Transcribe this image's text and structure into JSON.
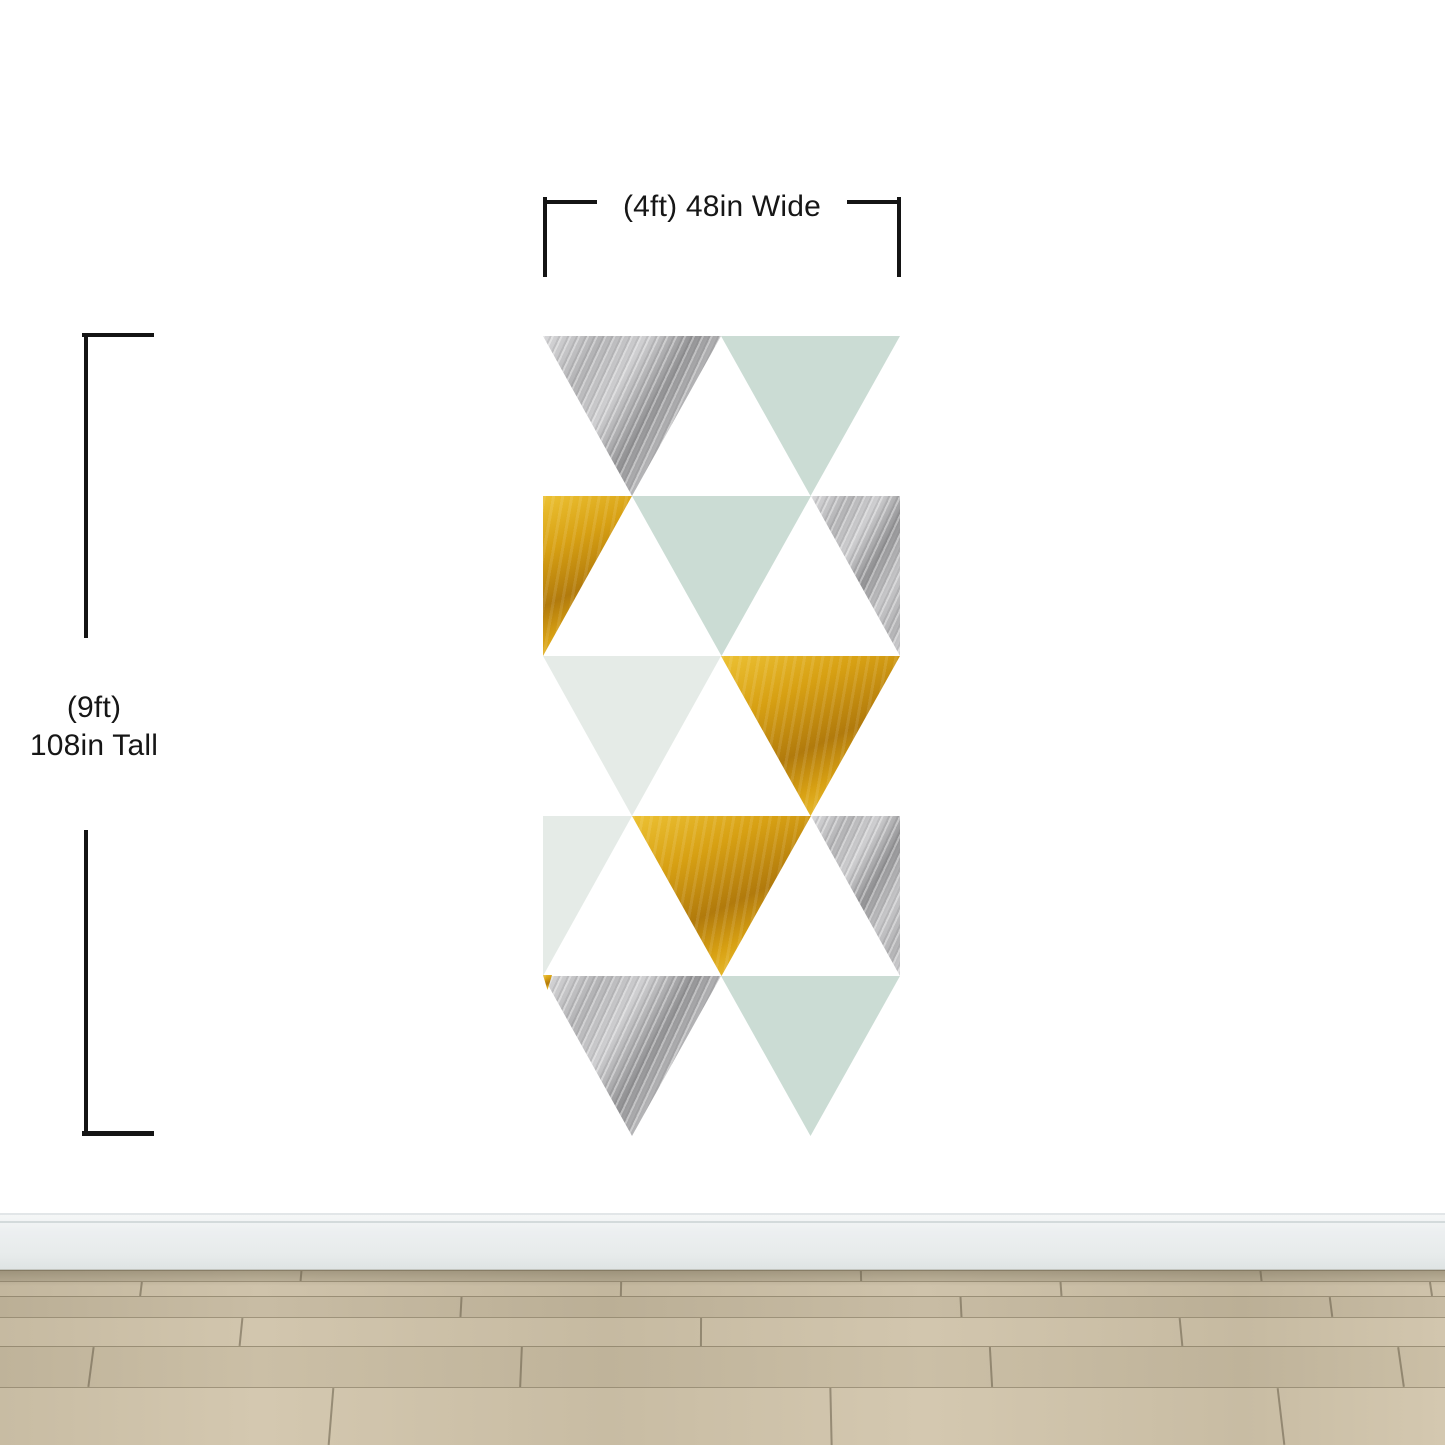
{
  "annotations": {
    "width_label": "(4ft) 48in Wide",
    "height_label_line1": "(9ft)",
    "height_label_line2": "108in Tall"
  },
  "colors": {
    "wall": "#ffffff",
    "ink": "#161616",
    "mint": "#cbdcd4",
    "mint_pale": "#e5ebe7",
    "silver_base": "#b3b3b5",
    "silver_light": "#d8d8da",
    "silver_dark": "#939395",
    "gold_base": "#d7a013",
    "gold_light": "#ecc133",
    "gold_dark": "#b17a0c",
    "baseboard": "#e7ebeb",
    "floor_base": "#c2b69c"
  },
  "mural": {
    "left": 543,
    "top": 336,
    "width": 357,
    "height": 800,
    "row_height": 160,
    "rows": [
      {
        "cells": [
          {
            "l": 0,
            "w": 178,
            "shape": "down",
            "color": "silver"
          },
          {
            "l": 178,
            "w": 179,
            "shape": "down",
            "color": "mint"
          }
        ]
      },
      {
        "cells": [
          {
            "l": 0,
            "w": 89,
            "shape": "halfL",
            "color": "gold"
          },
          {
            "l": 89,
            "w": 179,
            "shape": "down",
            "color": "mint"
          },
          {
            "l": 268,
            "w": 89,
            "shape": "halfR",
            "color": "silver"
          }
        ]
      },
      {
        "cells": [
          {
            "l": 0,
            "w": 178,
            "shape": "down",
            "color": "mint_pale"
          },
          {
            "l": 178,
            "w": 179,
            "shape": "down",
            "color": "gold"
          }
        ]
      },
      {
        "cells": [
          {
            "l": 0,
            "w": 89,
            "shape": "halfL",
            "color": "mint_pale"
          },
          {
            "l": 89,
            "w": 179,
            "shape": "down",
            "color": "gold"
          },
          {
            "l": 268,
            "w": 89,
            "shape": "halfR",
            "color": "silver"
          }
        ]
      },
      {
        "cells": [
          {
            "l": 0,
            "w": 178,
            "shape": "down",
            "color": "silver"
          },
          {
            "l": 178,
            "w": 179,
            "shape": "down",
            "color": "mint"
          }
        ]
      }
    ],
    "slivers": [
      {
        "l": 0,
        "t": 639,
        "w": 9,
        "h": 15,
        "shape": "down",
        "color": "gold"
      }
    ]
  },
  "floor": {
    "rows": [
      {
        "h": 11,
        "c1": "#b8ad95",
        "c2": "#c4b9a1",
        "joints": [
          300,
          860,
          1260
        ]
      },
      {
        "h": 15,
        "c1": "#c3b79e",
        "c2": "#cfc3ab",
        "joints": [
          140,
          620,
          1060,
          1430
        ]
      },
      {
        "h": 21,
        "c1": "#bbaf96",
        "c2": "#c8bca4",
        "joints": [
          460,
          960,
          1330
        ]
      },
      {
        "h": 29,
        "c1": "#c6baa1",
        "c2": "#d2c6ae",
        "joints": [
          240,
          700,
          1180
        ]
      },
      {
        "h": 41,
        "c1": "#bfb39a",
        "c2": "#cbbfa6",
        "joints": [
          90,
          520,
          990,
          1400
        ]
      },
      {
        "h": 58,
        "c1": "#c8bca3",
        "c2": "#d4c8b0",
        "joints": [
          330,
          830,
          1280
        ]
      }
    ]
  }
}
